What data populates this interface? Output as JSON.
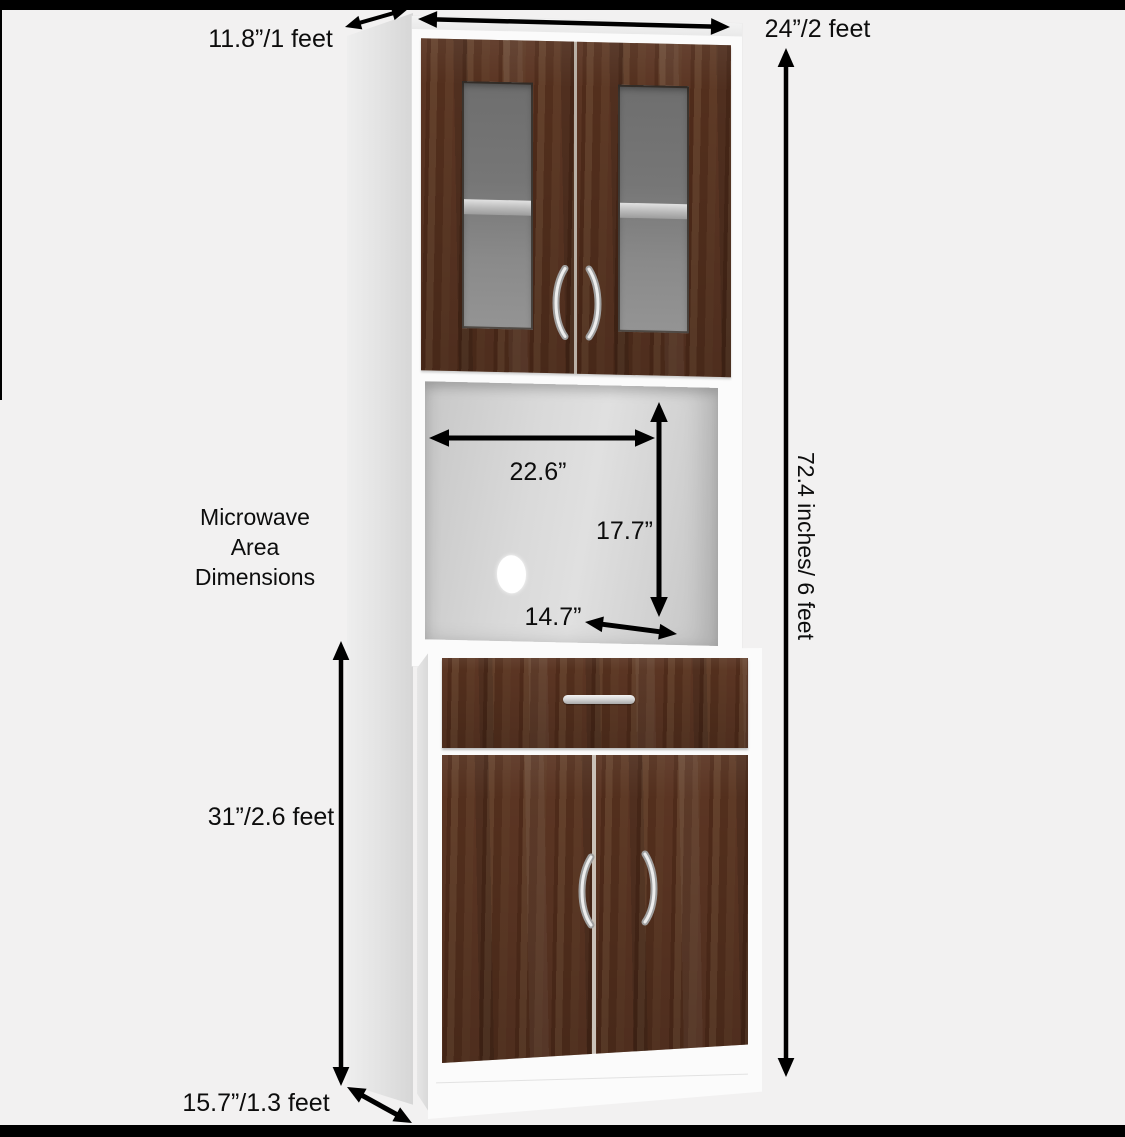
{
  "scene": {
    "description": "Microwave kitchen cabinet dimension diagram",
    "area_title_lines": [
      "Microwave",
      "Area",
      "Dimensions"
    ]
  },
  "labels": {
    "top_depth": "11.8”/1 feet",
    "top_width": "24”/2 feet",
    "total_height": "72.4 inches/ 6 feet",
    "microwave_width": "22.6”",
    "microwave_height": "17.7”",
    "microwave_depth": "14.7”",
    "lower_height": "31”/2.6 feet",
    "base_depth": "15.7”/1.3 feet"
  },
  "colors": {
    "background": "#f2f1f1",
    "frame_bar": "#000000",
    "cabinet_white": "#fbfbfb",
    "side_panel_gray": "#dcdcdc",
    "wood_dark": "#4f2b1a",
    "wood_mid": "#5b3523",
    "wood_light": "#63402b",
    "glass_gray": "#7d7d7d",
    "handle_silver": "#d8d8d8",
    "annotation_black": "#000000"
  }
}
